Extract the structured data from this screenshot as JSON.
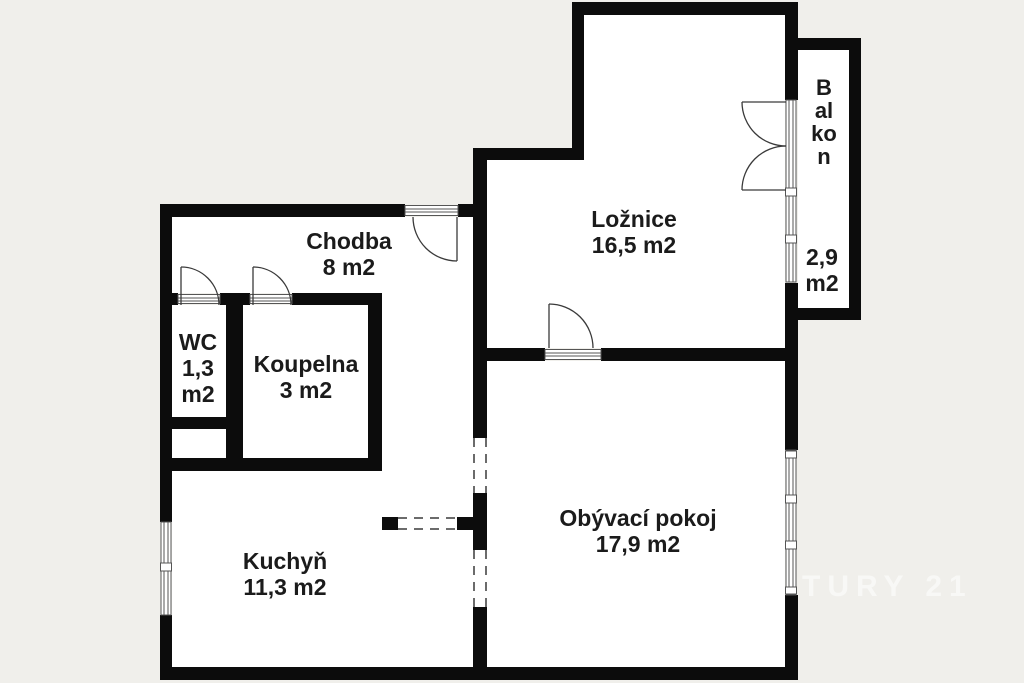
{
  "colors": {
    "background": "#f0efeb",
    "wall": "#0c0c0c",
    "room_fill": "#ffffff",
    "text": "#1b1b1b",
    "watermark": "#ffffff"
  },
  "rooms": {
    "chodba": {
      "name": "Chodba",
      "area": "8 m2"
    },
    "wc": {
      "name": "WC",
      "area": "1,3 m2"
    },
    "koupelna": {
      "name": "Koupelna",
      "area": "3 m2"
    },
    "loznice": {
      "name": "Ložnice",
      "area": "16,5 m2"
    },
    "balkon": {
      "name": "Balkon",
      "area": "2,9 m2"
    },
    "kuchyn": {
      "name": "Kuchyň",
      "area": "11,3 m2"
    },
    "obyvaci_pokoj": {
      "name": "Obývací pokoj",
      "area": "17,9 m2"
    }
  },
  "watermark": {
    "text": "TURY 21"
  }
}
